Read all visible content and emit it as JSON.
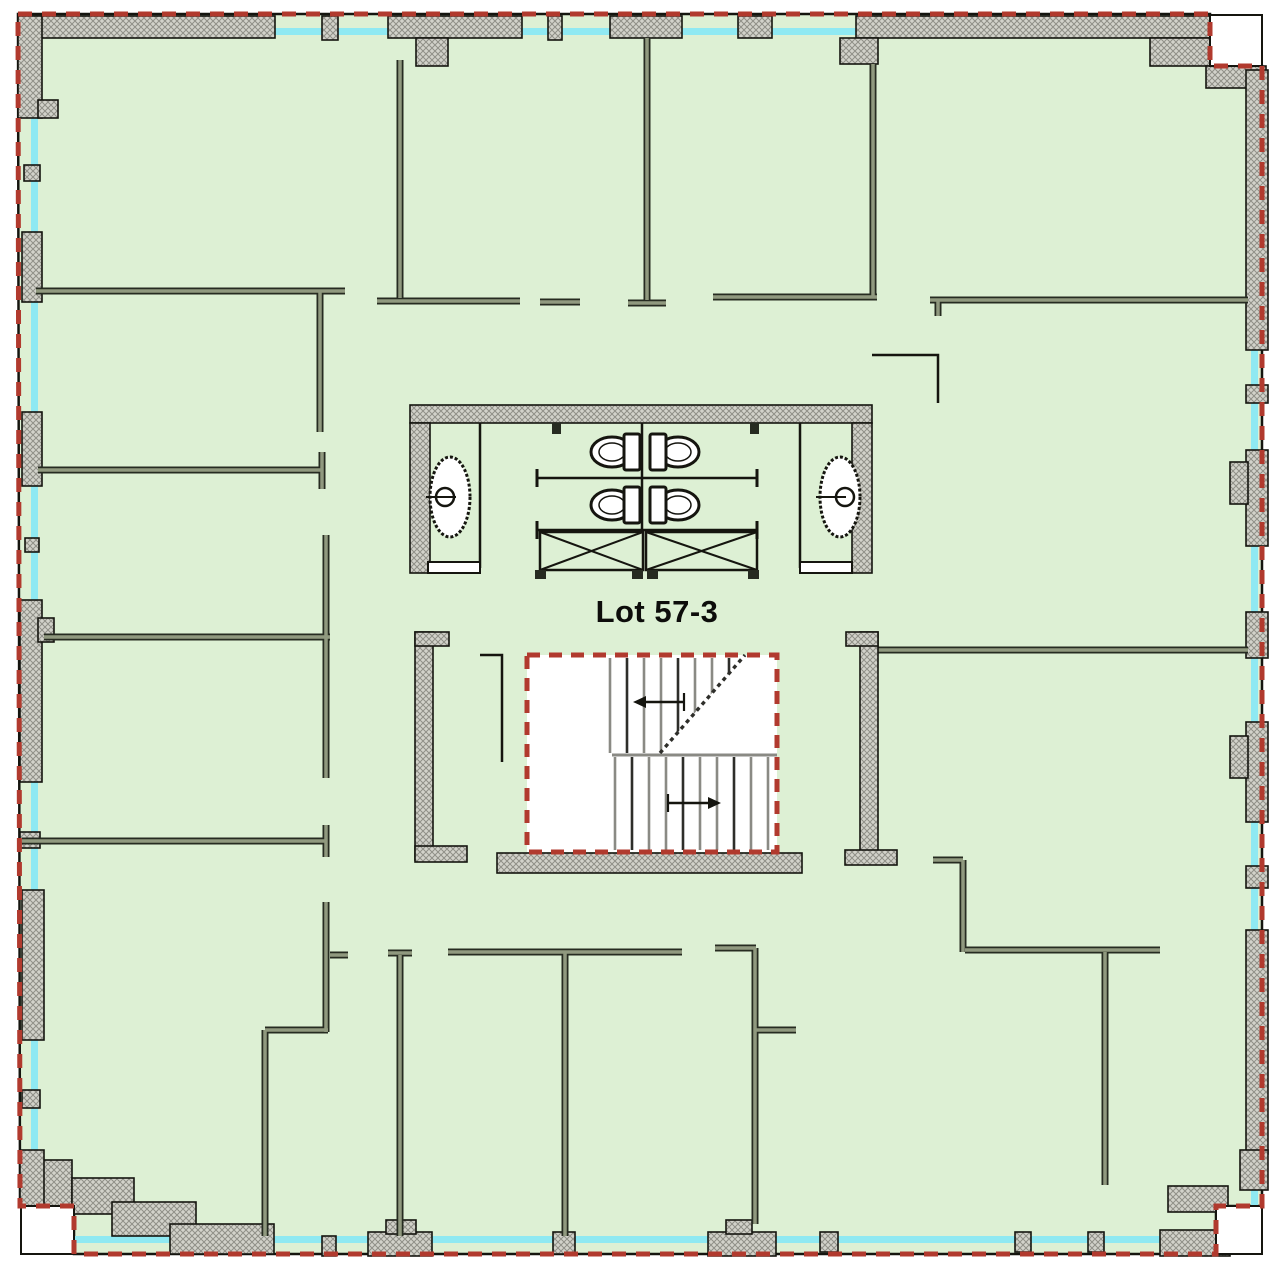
{
  "title": {
    "label": "Lot 57-3"
  },
  "canvas": {
    "width": 1280,
    "height": 1270,
    "background": "#ffffff"
  },
  "colors": {
    "floor": "#ddf0d4",
    "glazing": "#8fe9f2",
    "boundary_red": "#b13a2e",
    "wall_fill": "#d2d2ca",
    "wall_hatch": "#8f8f87",
    "wall_outline": "#15150f",
    "partition_dark": "#262b21",
    "partition_light": "#90997f",
    "thin_line": "#15150f",
    "tread_gray": "#8a8a84",
    "tread_dark": "#2e2e2a",
    "white": "#ffffff",
    "label_color": "#0d0d0b"
  },
  "boundary_path": "M 18 14 H 1210 V 66 H 1262 V 1206 H 1216 V 1254 H 74 V 1206 H 20 Z",
  "glazing": [
    {
      "x": 30,
      "y": 28,
      "w": 1182,
      "h": 7
    },
    {
      "x": 1251,
      "y": 30,
      "w": 7,
      "h": 1178
    },
    {
      "x": 74,
      "y": 1236,
      "w": 1142,
      "h": 7
    },
    {
      "x": 31,
      "y": 30,
      "w": 7,
      "h": 1176
    }
  ],
  "notches": [
    {
      "x": 1210,
      "y": 15,
      "w": 52,
      "h": 51
    },
    {
      "x": 21,
      "y": 1206,
      "w": 53,
      "h": 48
    },
    {
      "x": 1216,
      "y": 1206,
      "w": 46,
      "h": 48
    }
  ],
  "piers": [
    {
      "x": 18,
      "y": 16,
      "w": 257,
      "h": 22
    },
    {
      "x": 18,
      "y": 16,
      "w": 24,
      "h": 102
    },
    {
      "x": 38,
      "y": 100,
      "w": 20,
      "h": 18
    },
    {
      "x": 322,
      "y": 16,
      "w": 16,
      "h": 24
    },
    {
      "x": 388,
      "y": 16,
      "w": 134,
      "h": 22
    },
    {
      "x": 416,
      "y": 38,
      "w": 32,
      "h": 28
    },
    {
      "x": 548,
      "y": 16,
      "w": 14,
      "h": 24
    },
    {
      "x": 610,
      "y": 16,
      "w": 72,
      "h": 22
    },
    {
      "x": 738,
      "y": 16,
      "w": 34,
      "h": 22
    },
    {
      "x": 856,
      "y": 16,
      "w": 356,
      "h": 22
    },
    {
      "x": 840,
      "y": 38,
      "w": 38,
      "h": 26
    },
    {
      "x": 1150,
      "y": 38,
      "w": 62,
      "h": 28
    },
    {
      "x": 1206,
      "y": 66,
      "w": 60,
      "h": 22
    },
    {
      "x": 1246,
      "y": 70,
      "w": 22,
      "h": 280
    },
    {
      "x": 1246,
      "y": 385,
      "w": 22,
      "h": 18
    },
    {
      "x": 1246,
      "y": 450,
      "w": 22,
      "h": 96
    },
    {
      "x": 1230,
      "y": 462,
      "w": 18,
      "h": 42
    },
    {
      "x": 1246,
      "y": 612,
      "w": 22,
      "h": 46
    },
    {
      "x": 1246,
      "y": 722,
      "w": 22,
      "h": 100
    },
    {
      "x": 1230,
      "y": 736,
      "w": 18,
      "h": 42
    },
    {
      "x": 1246,
      "y": 866,
      "w": 22,
      "h": 22
    },
    {
      "x": 1246,
      "y": 930,
      "w": 22,
      "h": 224
    },
    {
      "x": 1240,
      "y": 1150,
      "w": 28,
      "h": 40
    },
    {
      "x": 1168,
      "y": 1186,
      "w": 60,
      "h": 26
    },
    {
      "x": 40,
      "y": 1160,
      "w": 32,
      "h": 48
    },
    {
      "x": 72,
      "y": 1178,
      "w": 62,
      "h": 36
    },
    {
      "x": 112,
      "y": 1202,
      "w": 84,
      "h": 34
    },
    {
      "x": 170,
      "y": 1224,
      "w": 104,
      "h": 30
    },
    {
      "x": 322,
      "y": 1236,
      "w": 14,
      "h": 20
    },
    {
      "x": 368,
      "y": 1232,
      "w": 64,
      "h": 24
    },
    {
      "x": 386,
      "y": 1220,
      "w": 30,
      "h": 14
    },
    {
      "x": 553,
      "y": 1232,
      "w": 22,
      "h": 22
    },
    {
      "x": 708,
      "y": 1232,
      "w": 68,
      "h": 24
    },
    {
      "x": 726,
      "y": 1220,
      "w": 26,
      "h": 14
    },
    {
      "x": 820,
      "y": 1232,
      "w": 18,
      "h": 20
    },
    {
      "x": 1015,
      "y": 1232,
      "w": 16,
      "h": 20
    },
    {
      "x": 1088,
      "y": 1232,
      "w": 16,
      "h": 20
    },
    {
      "x": 1160,
      "y": 1230,
      "w": 70,
      "h": 26
    },
    {
      "x": 24,
      "y": 165,
      "w": 16,
      "h": 16
    },
    {
      "x": 22,
      "y": 232,
      "w": 20,
      "h": 70
    },
    {
      "x": 22,
      "y": 412,
      "w": 20,
      "h": 74
    },
    {
      "x": 25,
      "y": 538,
      "w": 14,
      "h": 14
    },
    {
      "x": 20,
      "y": 600,
      "w": 22,
      "h": 182
    },
    {
      "x": 38,
      "y": 618,
      "w": 16,
      "h": 24
    },
    {
      "x": 20,
      "y": 832,
      "w": 20,
      "h": 16
    },
    {
      "x": 22,
      "y": 890,
      "w": 22,
      "h": 150
    },
    {
      "x": 22,
      "y": 1090,
      "w": 18,
      "h": 18
    },
    {
      "x": 20,
      "y": 1150,
      "w": 24,
      "h": 56
    }
  ],
  "core_walls": [
    {
      "x": 410,
      "y": 405,
      "w": 462,
      "h": 18
    },
    {
      "x": 410,
      "y": 423,
      "w": 20,
      "h": 150
    },
    {
      "x": 852,
      "y": 423,
      "w": 20,
      "h": 150
    },
    {
      "x": 415,
      "y": 632,
      "w": 18,
      "h": 228
    },
    {
      "x": 415,
      "y": 632,
      "w": 34,
      "h": 14
    },
    {
      "x": 415,
      "y": 846,
      "w": 52,
      "h": 16
    },
    {
      "x": 860,
      "y": 632,
      "w": 18,
      "h": 224
    },
    {
      "x": 846,
      "y": 632,
      "w": 32,
      "h": 14
    },
    {
      "x": 845,
      "y": 850,
      "w": 52,
      "h": 15
    },
    {
      "x": 497,
      "y": 853,
      "w": 305,
      "h": 20
    }
  ],
  "partitions": [
    [
      400,
      60,
      400,
      298
    ],
    [
      647,
      38,
      647,
      300
    ],
    [
      873,
      64,
      873,
      297
    ],
    [
      36,
      291,
      345,
      291
    ],
    [
      320,
      291,
      320,
      432
    ],
    [
      377,
      301,
      520,
      301
    ],
    [
      540,
      302,
      580,
      302
    ],
    [
      628,
      303,
      666,
      303
    ],
    [
      713,
      297,
      877,
      297
    ],
    [
      930,
      300,
      1248,
      300
    ],
    [
      938,
      300,
      938,
      316
    ],
    [
      38,
      470,
      322,
      470
    ],
    [
      322,
      452,
      322,
      489
    ],
    [
      326,
      535,
      326,
      778
    ],
    [
      44,
      637,
      330,
      637
    ],
    [
      22,
      841,
      326,
      841
    ],
    [
      326,
      825,
      326,
      857
    ],
    [
      326,
      902,
      326,
      1032
    ],
    [
      265,
      1030,
      328,
      1030
    ],
    [
      265,
      1030,
      265,
      1236
    ],
    [
      330,
      955,
      348,
      955
    ],
    [
      878,
      650,
      1248,
      650
    ],
    [
      933,
      860,
      963,
      860
    ],
    [
      963,
      860,
      963,
      952
    ],
    [
      965,
      950,
      1160,
      950
    ],
    [
      1105,
      952,
      1105,
      1185
    ],
    [
      448,
      952,
      682,
      952
    ],
    [
      565,
      952,
      565,
      1236
    ],
    [
      400,
      955,
      400,
      1236
    ],
    [
      388,
      953,
      412,
      953
    ],
    [
      715,
      948,
      756,
      948
    ],
    [
      755,
      948,
      755,
      1224
    ],
    [
      755,
      1030,
      796,
      1030
    ]
  ],
  "thin_walls": [
    [
      [
        480,
        655
      ],
      [
        502,
        655
      ],
      [
        502,
        762
      ]
    ],
    [
      [
        872,
        355
      ],
      [
        938,
        355
      ],
      [
        938,
        403
      ]
    ]
  ],
  "restroom": {
    "bay_lines": [
      [
        480,
        423,
        480,
        568
      ],
      [
        800,
        423,
        800,
        568
      ],
      [
        642,
        423,
        642,
        532
      ]
    ],
    "caps": [
      [
        428,
        562,
        52,
        11
      ],
      [
        800,
        562,
        52,
        11
      ]
    ],
    "stubs": [
      [
        552,
        423,
        9,
        11
      ],
      [
        750,
        423,
        9,
        11
      ]
    ],
    "dividers": [
      {
        "y": 478,
        "x1": 537,
        "x2": 757
      },
      {
        "y": 530,
        "x1": 537,
        "x2": 757
      }
    ],
    "counters": [
      {
        "x": 540,
        "y": 532,
        "w": 103,
        "h": 38
      },
      {
        "x": 646,
        "y": 532,
        "w": 111,
        "h": 38
      }
    ],
    "feet": [
      [
        535,
        570,
        11,
        9
      ],
      [
        632,
        570,
        11,
        9
      ],
      [
        647,
        570,
        11,
        9
      ],
      [
        748,
        570,
        11,
        9
      ]
    ],
    "ovals": [
      {
        "cx": 450,
        "cy": 497,
        "rx": 20,
        "ry": 40,
        "dotx": 445
      },
      {
        "cx": 840,
        "cy": 497,
        "rx": 20,
        "ry": 40,
        "dotx": 845
      }
    ],
    "toilets": [
      {
        "bowl": [
          612,
          452
        ],
        "tank": [
          624,
          434
        ]
      },
      {
        "bowl": [
          678,
          452
        ],
        "tank": [
          650,
          434
        ]
      },
      {
        "bowl": [
          612,
          505
        ],
        "tank": [
          624,
          487
        ]
      },
      {
        "bowl": [
          678,
          505
        ],
        "tank": [
          650,
          487
        ]
      }
    ],
    "bowl_rx": 21,
    "bowl_ry": 15,
    "tank_w": 16,
    "tank_h": 36
  },
  "stair": {
    "rect": {
      "x": 527,
      "y": 655,
      "w": 250,
      "h": 197
    },
    "dash": "13 9",
    "upper_treads": {
      "x0": 610,
      "step": 17,
      "count": 9,
      "y1": 658,
      "y2": 753
    },
    "white_mask": [
      [
        660,
        753
      ],
      [
        745,
        655
      ],
      [
        777,
        655
      ],
      [
        777,
        753
      ]
    ],
    "landing": [
      612,
      755,
      777,
      755
    ],
    "lower_treads": {
      "x0": 615,
      "step": 17,
      "count": 10,
      "y1": 757,
      "y2": 850
    },
    "diagonal": [
      660,
      753,
      745,
      655
    ],
    "arrows": [
      {
        "x1": 684,
        "y1": 702,
        "x2": 644,
        "y2": 702
      },
      {
        "x1": 668,
        "y1": 803,
        "x2": 710,
        "y2": 803
      }
    ]
  }
}
